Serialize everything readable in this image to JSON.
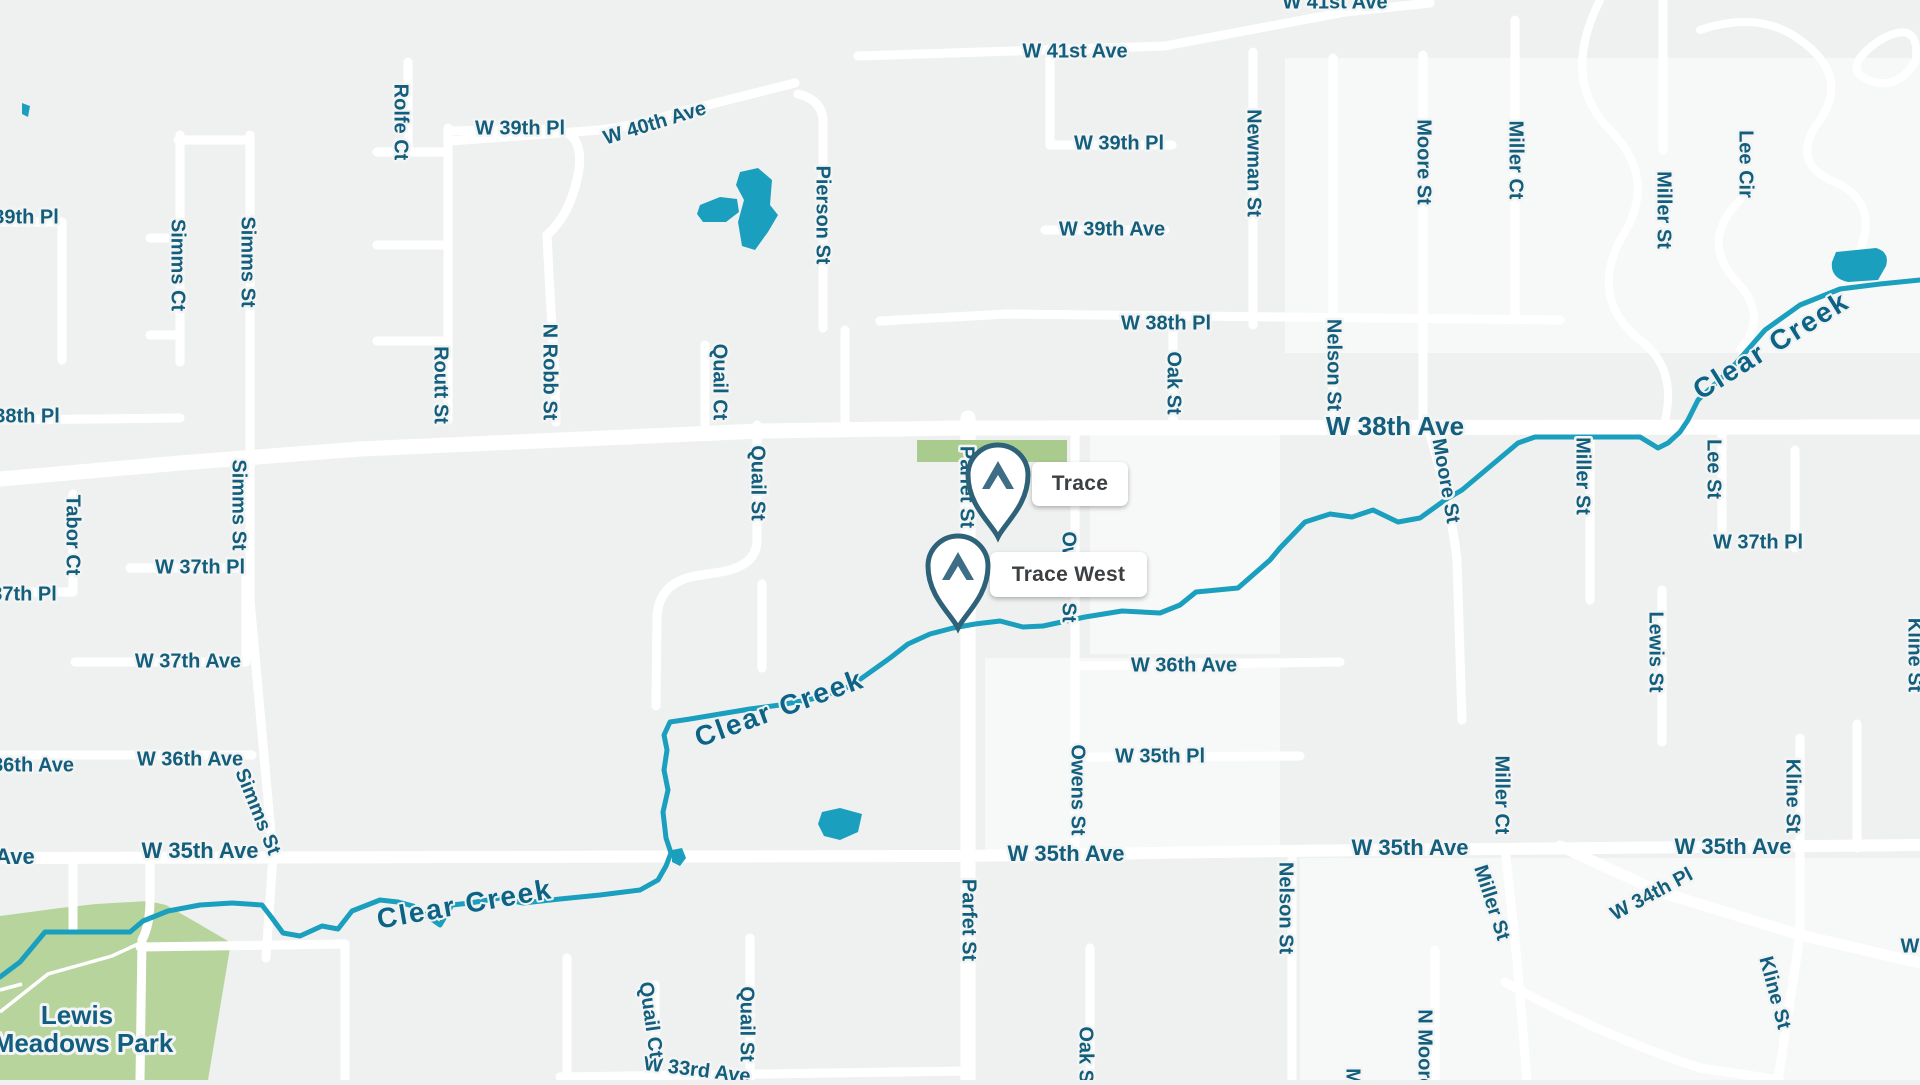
{
  "map": {
    "attribution": "street map of Wheat Ridge area",
    "colors": {
      "background": "#eff1f1",
      "light_block": "#f7f8f8",
      "road": "#ffffff",
      "water": "#1b9fbe",
      "park": "#b7d49c",
      "green_patch": "#a9cc8e",
      "street_label": "#135e7c",
      "creek_label": "#0c6385",
      "marker_text": "#3c4042",
      "pin_stroke": "#2e6278",
      "pin_icon": "#3e6e86"
    },
    "markers": [
      {
        "id": "trace",
        "label": "Trace",
        "tip_x": 998,
        "tip_y": 537,
        "box": {
          "x": 1032,
          "y": 462,
          "w": 96,
          "h": 44
        }
      },
      {
        "id": "trace-west",
        "label": "Trace West",
        "tip_x": 958,
        "tip_y": 628,
        "box": {
          "x": 990,
          "y": 552,
          "w": 157,
          "h": 45
        }
      }
    ],
    "park_label": {
      "line1": "Lewis",
      "line2": "Meadows Park",
      "x1": 77,
      "y1": 1017,
      "x2": 83,
      "y2": 1045
    },
    "street_labels": [
      {
        "t": "W 41st Ave",
        "x": 1075,
        "y": 52
      },
      {
        "t": "W 41st Ave",
        "x": 1335,
        "y": 3
      },
      {
        "t": "W 39th Pl",
        "x": 520,
        "y": 129
      },
      {
        "t": "W 40th Ave",
        "x": 655,
        "y": 124,
        "r": -17
      },
      {
        "t": "W 39th Pl",
        "x": 1119,
        "y": 144
      },
      {
        "t": "W 39th Ave",
        "x": 1112,
        "y": 230
      },
      {
        "t": "W 38th Pl",
        "x": 1166,
        "y": 324
      },
      {
        "t": "39th Pl",
        "x": 26,
        "y": 218
      },
      {
        "t": "38th Pl",
        "x": 27,
        "y": 417
      },
      {
        "t": "W 38th Ave",
        "x": 1395,
        "y": 428,
        "s": "lg"
      },
      {
        "t": "W 37th Pl",
        "x": 200,
        "y": 568
      },
      {
        "t": "37th Pl",
        "x": 24,
        "y": 595
      },
      {
        "t": "W 37th Ave",
        "x": 188,
        "y": 662
      },
      {
        "t": "W 37th Pl",
        "x": 1758,
        "y": 543
      },
      {
        "t": "W 36th Ave",
        "x": 190,
        "y": 760
      },
      {
        "t": "36th Ave",
        "x": 33,
        "y": 766
      },
      {
        "t": "W 36th Ave",
        "x": 1184,
        "y": 666
      },
      {
        "t": "W 35th Ave",
        "x": 200,
        "y": 852,
        "s": "md"
      },
      {
        "t": "Ave",
        "x": 15,
        "y": 858,
        "s": "md"
      },
      {
        "t": "W 35th Pl",
        "x": 1160,
        "y": 757
      },
      {
        "t": "W 35th Ave",
        "x": 1066,
        "y": 855,
        "s": "md"
      },
      {
        "t": "W 35th Ave",
        "x": 1410,
        "y": 849,
        "s": "md"
      },
      {
        "t": "W 35th Ave",
        "x": 1733,
        "y": 848,
        "s": "md"
      },
      {
        "t": "W 34th Pl",
        "x": 1652,
        "y": 895,
        "r": -28
      },
      {
        "t": "W 33rd Ave",
        "x": 697,
        "y": 1071,
        "r": 7
      },
      {
        "t": "W",
        "x": 1910,
        "y": 947
      },
      {
        "t": "Rolfe Ct",
        "x": 400,
        "y": 122,
        "r": 90
      },
      {
        "t": "Simms Ct",
        "x": 177,
        "y": 265,
        "r": 90
      },
      {
        "t": "Simms St",
        "x": 247,
        "y": 262,
        "r": 90
      },
      {
        "t": "Simms St",
        "x": 238,
        "y": 505,
        "r": 90
      },
      {
        "t": "Simms St",
        "x": 257,
        "y": 812,
        "r": 68
      },
      {
        "t": "Routt St",
        "x": 440,
        "y": 385,
        "r": 90
      },
      {
        "t": "N Robb St",
        "x": 549,
        "y": 372,
        "r": 90
      },
      {
        "t": "Tabor Ct",
        "x": 72,
        "y": 535,
        "r": 90
      },
      {
        "t": "Quail Ct",
        "x": 719,
        "y": 382,
        "r": 90
      },
      {
        "t": "Quail St",
        "x": 757,
        "y": 483,
        "r": 90
      },
      {
        "t": "Pierson St",
        "x": 822,
        "y": 215,
        "r": 90
      },
      {
        "t": "Newman St",
        "x": 1253,
        "y": 163,
        "r": 90
      },
      {
        "t": "Moore St",
        "x": 1423,
        "y": 162,
        "r": 90
      },
      {
        "t": "Miller Ct",
        "x": 1515,
        "y": 160,
        "r": 90
      },
      {
        "t": "Miller St",
        "x": 1663,
        "y": 210,
        "r": 90
      },
      {
        "t": "Lee Cir",
        "x": 1745,
        "y": 164,
        "r": 90
      },
      {
        "t": "Oak St",
        "x": 1173,
        "y": 383,
        "r": 90
      },
      {
        "t": "Nelson St",
        "x": 1333,
        "y": 365,
        "r": 90
      },
      {
        "t": "Nelson St",
        "x": 1285,
        "y": 908,
        "r": 90
      },
      {
        "t": "Moore St",
        "x": 1445,
        "y": 481,
        "r": 80
      },
      {
        "t": "Miller St",
        "x": 1582,
        "y": 476,
        "r": 90
      },
      {
        "t": "Lee St",
        "x": 1713,
        "y": 469,
        "r": 90
      },
      {
        "t": "Lewis St",
        "x": 1655,
        "y": 652,
        "r": 90
      },
      {
        "t": "Owens St",
        "x": 1068,
        "y": 577,
        "r": 90
      },
      {
        "t": "Owens St",
        "x": 1077,
        "y": 790,
        "r": 90
      },
      {
        "t": "Parfet St",
        "x": 966,
        "y": 487,
        "r": 90
      },
      {
        "t": "Parfet St",
        "x": 968,
        "y": 920,
        "r": 90
      },
      {
        "t": "Oak St",
        "x": 1085,
        "y": 1058,
        "r": 90
      },
      {
        "t": "Quail Ct",
        "x": 650,
        "y": 1020,
        "r": 82
      },
      {
        "t": "Quail St",
        "x": 746,
        "y": 1024,
        "r": 90
      },
      {
        "t": "Kline St",
        "x": 1792,
        "y": 796,
        "r": 90
      },
      {
        "t": "Kline St",
        "x": 1774,
        "y": 993,
        "r": 75
      },
      {
        "t": "Miller St",
        "x": 1491,
        "y": 903,
        "r": 72
      },
      {
        "t": "Miller Ct",
        "x": 1501,
        "y": 795,
        "r": 90
      },
      {
        "t": "N Moore St",
        "x": 1424,
        "y": 1062,
        "r": 90
      },
      {
        "t": "Mc",
        "x": 1352,
        "y": 1082,
        "r": 90
      },
      {
        "t": "Kline St",
        "x": 1914,
        "y": 655,
        "r": 90
      }
    ],
    "creek_labels": [
      {
        "t": "Clear Creek",
        "x": 780,
        "y": 710,
        "r": -20
      },
      {
        "t": "Clear Creek",
        "x": 465,
        "y": 906,
        "r": -10
      },
      {
        "t": "Clear Creek",
        "x": 1772,
        "y": 347,
        "r": -32
      }
    ],
    "creek_path": [
      [
        0,
        977
      ],
      [
        20,
        962
      ],
      [
        45,
        932
      ],
      [
        130,
        932
      ],
      [
        143,
        921
      ],
      [
        168,
        911
      ],
      [
        200,
        905
      ],
      [
        232,
        903
      ],
      [
        262,
        905
      ],
      [
        272,
        918
      ],
      [
        283,
        933
      ],
      [
        300,
        936
      ],
      [
        322,
        926
      ],
      [
        338,
        929
      ],
      [
        352,
        911
      ],
      [
        380,
        900
      ],
      [
        398,
        902
      ],
      [
        413,
        906
      ],
      [
        440,
        925
      ],
      [
        452,
        905
      ],
      [
        470,
        903
      ],
      [
        500,
        898
      ],
      [
        523,
        903
      ],
      [
        560,
        899
      ],
      [
        600,
        895
      ],
      [
        640,
        890
      ],
      [
        658,
        880
      ],
      [
        666,
        866
      ],
      [
        671,
        853
      ],
      [
        666,
        838
      ],
      [
        663,
        812
      ],
      [
        668,
        790
      ],
      [
        664,
        770
      ],
      [
        667,
        750
      ],
      [
        664,
        735
      ],
      [
        670,
        722
      ],
      [
        690,
        719
      ],
      [
        720,
        714
      ],
      [
        750,
        709
      ],
      [
        780,
        705
      ],
      [
        812,
        699
      ],
      [
        843,
        690
      ],
      [
        862,
        678
      ],
      [
        890,
        658
      ],
      [
        908,
        644
      ],
      [
        930,
        634
      ],
      [
        953,
        628
      ],
      [
        975,
        624
      ],
      [
        1000,
        621
      ],
      [
        1023,
        627
      ],
      [
        1043,
        626
      ],
      [
        1085,
        617
      ],
      [
        1122,
        611
      ],
      [
        1160,
        613
      ],
      [
        1180,
        605
      ],
      [
        1196,
        592
      ],
      [
        1238,
        588
      ],
      [
        1270,
        560
      ],
      [
        1280,
        548
      ],
      [
        1305,
        522
      ],
      [
        1330,
        514
      ],
      [
        1352,
        517
      ],
      [
        1373,
        510
      ],
      [
        1398,
        522
      ],
      [
        1420,
        518
      ],
      [
        1445,
        500
      ],
      [
        1462,
        490
      ],
      [
        1518,
        443
      ],
      [
        1535,
        437
      ],
      [
        1640,
        437
      ],
      [
        1658,
        448
      ],
      [
        1668,
        443
      ],
      [
        1680,
        432
      ],
      [
        1688,
        420
      ],
      [
        1698,
        400
      ],
      [
        1730,
        370
      ],
      [
        1765,
        330
      ],
      [
        1800,
        305
      ],
      [
        1840,
        289
      ],
      [
        1880,
        284
      ],
      [
        1920,
        280
      ]
    ],
    "roads": [
      {
        "d": "M0,479 L180,463 L360,449 L560,440 L760,431 L960,428 L1920,427",
        "w": 15
      },
      {
        "d": "M0,858 L960,856 L1280,851 L1920,845",
        "w": 12
      },
      {
        "d": "M968,418 L968,1080",
        "w": 15
      },
      {
        "d": "M858,56 L1165,46 L1345,12 L1430,3",
        "w": 9
      },
      {
        "d": "M450,141 L600,130 Q640,125 680,112 L795,83"
      },
      {
        "d": "M448,128 L448,420"
      },
      {
        "d": "M448,131 L555,129 Q586,133 578,175 Q570,215 547,235 Q550,300 554,355 L556,422"
      },
      {
        "d": "M408,62 L408,152"
      },
      {
        "d": "M377,152 L448,152"
      },
      {
        "d": "M377,245 L448,245"
      },
      {
        "d": "M377,341 L448,341"
      },
      {
        "d": "M180,135 L180,362"
      },
      {
        "d": "M250,135 L250,600 L273,856"
      },
      {
        "d": "M273,856 L266,958"
      },
      {
        "d": "M150,238 L180,238"
      },
      {
        "d": "M150,335 L180,335"
      },
      {
        "d": "M178,140 L250,140"
      },
      {
        "d": "M0,222 L62,222"
      },
      {
        "d": "M62,222 L62,360"
      },
      {
        "d": "M0,420 L180,418"
      },
      {
        "d": "M73,494 L73,592"
      },
      {
        "d": "M130,568 L246,568"
      },
      {
        "d": "M0,592 L73,592"
      },
      {
        "d": "M75,662 L246,662"
      },
      {
        "d": "M246,568 L246,662"
      },
      {
        "d": "M0,755 L252,755"
      },
      {
        "d": "M705,345 L705,424"
      },
      {
        "d": "M823,118 L823,328"
      },
      {
        "d": "M823,122 Q823,100 798,94"
      },
      {
        "d": "M845,330 L845,424"
      },
      {
        "d": "M880,321 L1007,314 L1560,320"
      },
      {
        "d": "M757,425 L757,540 Q757,568 714,573 L702,575 Q658,580 657,618 L656,706"
      },
      {
        "d": "M762,584 L762,668"
      },
      {
        "d": "M1075,428 L1075,857"
      },
      {
        "d": "M1173,325 L1173,427"
      },
      {
        "d": "M1253,52 L1253,325"
      },
      {
        "d": "M1333,58 L1333,427"
      },
      {
        "d": "M1423,55 L1423,427"
      },
      {
        "d": "M1515,20 L1515,320"
      },
      {
        "d": "M1663,0 L1663,150"
      },
      {
        "d": "M1050,52 L1050,145"
      },
      {
        "d": "M1050,145 L1172,145"
      },
      {
        "d": "M1045,230 L1165,230"
      },
      {
        "d": "M1590,428 L1590,600"
      },
      {
        "d": "M1428,428 Q1450,500 1457,560 L1462,720"
      },
      {
        "d": "M1722,428 L1722,546"
      },
      {
        "d": "M1662,590 L1662,742"
      },
      {
        "d": "M1795,450 L1795,548"
      },
      {
        "d": "M1075,666 L1340,662"
      },
      {
        "d": "M1090,757 L1300,756"
      },
      {
        "d": "M1292,853 L1292,1080"
      },
      {
        "d": "M1505,848 L1517,960 L1527,1080"
      },
      {
        "d": "M1560,846 L1660,892 L1800,935 L1920,963",
        "w": 11
      },
      {
        "d": "M1505,982 Q1600,1035 1700,1068 L1780,1080"
      },
      {
        "d": "M1800,738 L1800,935"
      },
      {
        "d": "M1800,935 L1778,1080"
      },
      {
        "d": "M1857,724 L1857,848"
      },
      {
        "d": "M560,1077 L968,1071"
      },
      {
        "d": "M750,938 L750,1080"
      },
      {
        "d": "M655,985 L655,1080"
      },
      {
        "d": "M150,858 L150,900 Q150,925 142,940 L140,1080"
      },
      {
        "d": "M140,947 L345,944"
      },
      {
        "d": "M345,944 L345,1080"
      },
      {
        "d": "M567,958 L567,1080"
      },
      {
        "d": "M73,858 L73,930"
      },
      {
        "d": "M1435,950 L1435,1080"
      },
      {
        "d": "M1090,948 L1090,1080"
      },
      {
        "d": "M1600,0 Q1560,80 1610,130 Q1660,180 1620,240 Q1590,300 1640,340 Q1680,370 1663,428",
        "w": 8
      },
      {
        "d": "M1700,30 Q1760,10 1800,40 Q1850,75 1820,120 Q1790,160 1830,180 Q1880,200 1860,250",
        "w": 8
      },
      {
        "d": "M1740,200 Q1700,240 1735,280 Q1770,315 1740,350",
        "w": 8
      },
      {
        "d": "M1880,40 Q1920,18 1916,60 Q1898,92 1868,80 Q1840,68 1880,40",
        "w": 8
      }
    ],
    "trails": [
      {
        "d": "M0,1012 L48,974 L112,956 L138,944"
      },
      {
        "d": "M0,990 L22,984"
      }
    ],
    "light_blocks": [
      {
        "x": 1285,
        "y": 58,
        "w": 635,
        "h": 295
      },
      {
        "x": 1090,
        "y": 432,
        "w": 190,
        "h": 222
      },
      {
        "x": 985,
        "y": 658,
        "w": 295,
        "h": 195
      },
      {
        "x": 1300,
        "y": 858,
        "w": 620,
        "h": 222
      }
    ],
    "parks": [
      {
        "name": "Lewis Meadows Park",
        "points": "0,916 60,908 96,904 148,901 166,905 199,924 228,941 230,948 208,1080 0,1080"
      }
    ],
    "green_patch": {
      "x": 917,
      "y": 440,
      "w": 150,
      "h": 22
    },
    "ponds": [
      {
        "d": "M740,172 L758,168 L772,180 L770,205 L778,215 L768,232 L755,250 L742,246 L738,222 L744,200 L736,185 Z"
      },
      {
        "d": "M700,205 L720,197 L737,199 L739,212 L726,222 L703,222 L697,214 Z"
      },
      {
        "d": "M1836,252 L1876,248 Q1890,252 1886,266 L1878,280 L1848,282 Q1830,278 1832,262 Z"
      },
      {
        "d": "M822,812 L840,808 L862,814 L858,832 L840,840 L824,836 L818,824 Z"
      },
      {
        "d": "M672,850 L682,848 L686,858 L680,866 L672,862 Z"
      },
      {
        "d": "M22,103 L30,106 L28,117 L22,114 Z"
      }
    ]
  }
}
